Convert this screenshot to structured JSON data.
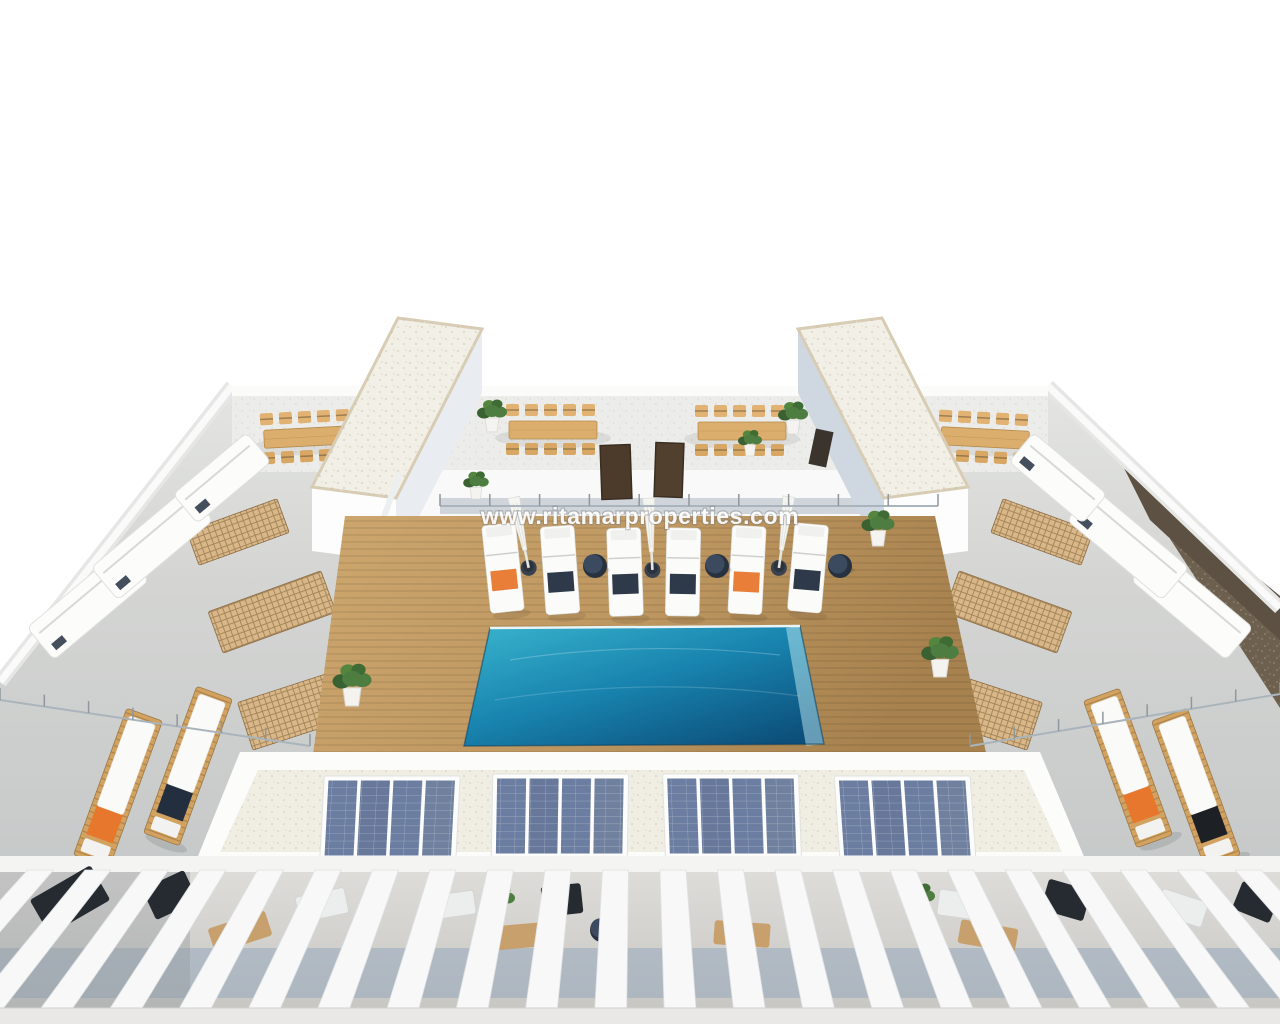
{
  "scene": {
    "type": "3d-architectural-render-aerial",
    "description": "Aerial 3D render of a new-build apartment building rooftop solarium: turquoise communal pool on a wooden deck, white sun loungers with orange and navy towels, closed parasols, four rooftop dining sets, two gravel-roofed stair towers, grey side terraces with white lounge sofas and timber vent grilles, four photovoltaic panel arrays on the gravel facade strip, and a row of white pergola beams over the lower private terraces. Brown hillside visible at the right edge.",
    "watermark": "www.ritamarproperties.com"
  },
  "colors": {
    "white": "#ffffff",
    "concrete": "#d4d5d3",
    "concrete_dark": "#c0c3c4",
    "gravel": "#f0ede3",
    "stone_edge": "#9aa0a4",
    "wall_shade": "#cfd7e1",
    "wood_deck": "#c49c63",
    "wood_deck_dark": "#a7824e",
    "wood_furniture": "#dcae6d",
    "pool_light": "#35b2cd",
    "pool_mid": "#1884af",
    "pool_dark": "#0c4f7a",
    "solar_panel": "#6b7da0",
    "accent_orange": "#e8772e",
    "accent_navy": "#232f3f",
    "accent_black": "#1d2126",
    "plant_green": "#4e7d42",
    "plant_dark": "#3a6132",
    "shadow_blue": "#92a6bc",
    "hill_brown": "#6e604f",
    "hill_dark": "#4a4038",
    "door_brown": "#4c3b2b"
  },
  "inventory": {
    "pool": {
      "count": 1,
      "shape": "rectangular",
      "water": "turquoise"
    },
    "pool_loungers": {
      "count": 6,
      "towel_colors": [
        "orange",
        "navy",
        "navy",
        "navy",
        "orange",
        "navy"
      ]
    },
    "closed_parasols": {
      "count": 3
    },
    "round_side_tables": {
      "count": 3
    },
    "rooftop_dining_sets": {
      "count": 4
    },
    "solar_arrays": {
      "count": 4,
      "panels_per_array": 4
    },
    "corner_wood_loungers": {
      "count": 4,
      "towel_colors": [
        "orange",
        "navy",
        "orange",
        "black"
      ]
    },
    "stair_towers": {
      "count": 2,
      "roof": "gravel"
    },
    "roof_access_doors": {
      "count": 2
    },
    "potted_plants": {
      "count": 10
    },
    "pergola": {
      "style": "white beams over lower terraces"
    }
  },
  "layout": {
    "deck": {
      "top": 516,
      "bottom": 760,
      "xtl": 345,
      "xtr": 935,
      "xbl": 312,
      "xbr": 988,
      "plank_spacing": 7
    },
    "pool_loungers": [
      {
        "x": 503,
        "y": 568,
        "r": -6,
        "towel": "accent_orange"
      },
      {
        "x": 560,
        "y": 570,
        "r": -4,
        "towel": "accent_navy"
      },
      {
        "x": 625,
        "y": 572,
        "r": -2,
        "towel": "accent_navy"
      },
      {
        "x": 683,
        "y": 572,
        "r": 1,
        "towel": "accent_navy"
      },
      {
        "x": 747,
        "y": 570,
        "r": 3,
        "towel": "accent_orange"
      },
      {
        "x": 808,
        "y": 568,
        "r": 5,
        "towel": "accent_navy"
      }
    ],
    "side_tables": [
      {
        "x": 595,
        "y": 566
      },
      {
        "x": 717,
        "y": 566
      },
      {
        "x": 840,
        "y": 566
      }
    ],
    "umbrellas": [
      {
        "x": 527,
        "y": 560,
        "r": -12
      },
      {
        "x": 652,
        "y": 562,
        "r": -3
      },
      {
        "x": 780,
        "y": 560,
        "r": 8
      }
    ],
    "dining_sets": [
      {
        "x": 308,
        "y": 437,
        "r": -3
      },
      {
        "x": 553,
        "y": 430,
        "r": 0
      },
      {
        "x": 742,
        "y": 431,
        "r": 0
      },
      {
        "x": 985,
        "y": 438,
        "r": 3
      }
    ],
    "solar_arrays": [
      {
        "x": 390,
        "y": 818,
        "skew": -3
      },
      {
        "x": 560,
        "y": 816,
        "skew": -1
      },
      {
        "x": 732,
        "y": 816,
        "skew": 2
      },
      {
        "x": 905,
        "y": 818,
        "skew": 4
      }
    ],
    "wood_loungers": [
      {
        "x": 118,
        "y": 788,
        "r": 20,
        "towel": "accent_orange"
      },
      {
        "x": 188,
        "y": 766,
        "r": 20,
        "towel": "accent_navy"
      },
      {
        "x": 1128,
        "y": 768,
        "r": -20,
        "towel": "accent_orange"
      },
      {
        "x": 1196,
        "y": 788,
        "r": -20,
        "towel": "accent_black"
      }
    ],
    "plants": [
      {
        "x": 492,
        "y": 412,
        "s": 1.0
      },
      {
        "x": 476,
        "y": 482,
        "s": 0.85
      },
      {
        "x": 793,
        "y": 414,
        "s": 1.0
      },
      {
        "x": 750,
        "y": 440,
        "s": 0.8
      },
      {
        "x": 352,
        "y": 680,
        "s": 1.3
      },
      {
        "x": 940,
        "y": 652,
        "s": 1.25
      },
      {
        "x": 878,
        "y": 524,
        "s": 1.1
      }
    ],
    "sofas": [
      {
        "x": 88,
        "y": 604,
        "w": 124,
        "h": 42,
        "r": -40
      },
      {
        "x": 152,
        "y": 544,
        "w": 124,
        "h": 42,
        "r": -40
      },
      {
        "x": 222,
        "y": 478,
        "w": 96,
        "h": 38,
        "r": -40
      },
      {
        "x": 1192,
        "y": 604,
        "w": 124,
        "h": 42,
        "r": 40
      },
      {
        "x": 1128,
        "y": 544,
        "w": 124,
        "h": 42,
        "r": 40
      },
      {
        "x": 1058,
        "y": 478,
        "w": 96,
        "h": 38,
        "r": 40
      }
    ],
    "grates": [
      {
        "x": 238,
        "y": 532,
        "w": 96,
        "h": 36,
        "r": -20
      },
      {
        "x": 272,
        "y": 612,
        "w": 120,
        "h": 44,
        "r": -20
      },
      {
        "x": 308,
        "y": 706,
        "w": 132,
        "h": 50,
        "r": -18
      },
      {
        "x": 1042,
        "y": 532,
        "w": 96,
        "h": 36,
        "r": 20
      },
      {
        "x": 1008,
        "y": 612,
        "w": 120,
        "h": 44,
        "r": 20
      },
      {
        "x": 972,
        "y": 706,
        "w": 132,
        "h": 50,
        "r": 18
      }
    ],
    "balustrades": [
      {
        "x1": 440,
        "y1": 506,
        "x2": 938,
        "y2": 506,
        "posts": 10
      },
      {
        "x1": 0,
        "y1": 700,
        "x2": 310,
        "y2": 746,
        "posts": 7
      },
      {
        "x1": 1280,
        "y1": 694,
        "x2": 970,
        "y2": 746,
        "posts": 7
      }
    ],
    "pergola": {
      "top": 870,
      "bottom": 1012,
      "count": 24,
      "pitch": 57.5,
      "x0": -30,
      "lean": 0.21,
      "w_top": 26,
      "w_bottom": 32
    },
    "gap_items": [
      {
        "t": "dark",
        "x": 70,
        "y": 900,
        "w": 70,
        "h": 40,
        "r": -30
      },
      {
        "t": "dark",
        "x": 170,
        "y": 895,
        "w": 46,
        "h": 34,
        "r": -25
      },
      {
        "t": "rug",
        "x": 240,
        "y": 932,
        "w": 60,
        "h": 26,
        "r": -18
      },
      {
        "t": "sofa",
        "x": 322,
        "y": 905,
        "w": 50,
        "h": 26,
        "r": -12
      },
      {
        "t": "sofa",
        "x": 452,
        "y": 905,
        "w": 46,
        "h": 24,
        "r": -8
      },
      {
        "t": "plant",
        "x": 500,
        "y": 898
      },
      {
        "t": "dark",
        "x": 562,
        "y": 900,
        "w": 40,
        "h": 30,
        "r": -6
      },
      {
        "t": "rug",
        "x": 522,
        "y": 936,
        "w": 56,
        "h": 24,
        "r": -5
      },
      {
        "t": "table",
        "x": 602,
        "y": 930
      },
      {
        "t": "rug",
        "x": 742,
        "y": 934,
        "w": 56,
        "h": 24,
        "r": 4
      },
      {
        "t": "plant",
        "x": 920,
        "y": 896
      },
      {
        "t": "sofa",
        "x": 962,
        "y": 905,
        "w": 48,
        "h": 26,
        "r": 8
      },
      {
        "t": "rug",
        "x": 988,
        "y": 936,
        "w": 58,
        "h": 24,
        "r": 10
      },
      {
        "t": "dark",
        "x": 1066,
        "y": 900,
        "w": 44,
        "h": 32,
        "r": 16
      },
      {
        "t": "sofa",
        "x": 1182,
        "y": 908,
        "w": 48,
        "h": 26,
        "r": 18
      },
      {
        "t": "dark",
        "x": 1256,
        "y": 902,
        "w": 40,
        "h": 30,
        "r": 22
      }
    ]
  }
}
